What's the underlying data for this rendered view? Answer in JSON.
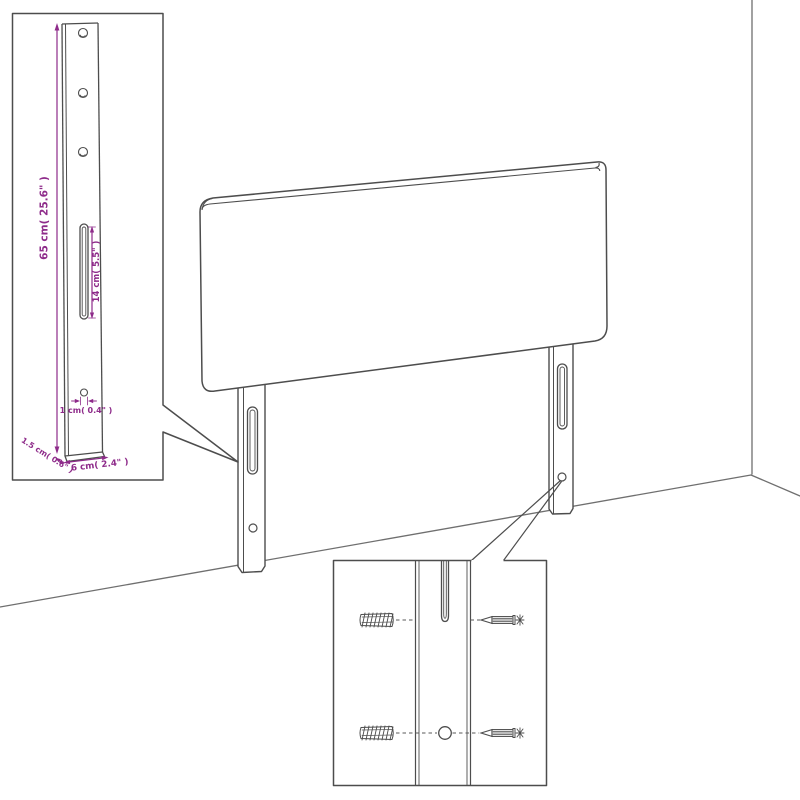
{
  "colors": {
    "outline": "#4d4d4d",
    "wall_line": "#6f6f6f",
    "dimension": "#8e2b8a",
    "background": "#ffffff"
  },
  "dimensions": {
    "leg_height": "65 cm( 25.6\" )",
    "slot_length": "14 cm( 5.5\" )",
    "hole_diameter": "1 cm( 0.4\" )",
    "leg_depth": "1.5 cm( 0.6\" )",
    "leg_width": "6 cm( 2.4\" )"
  },
  "icons": {
    "wall_plug": "wall-plug-icon",
    "screw": "screw-icon",
    "leg_slot": "mounting-slot",
    "screw_hole": "screw-hole"
  }
}
